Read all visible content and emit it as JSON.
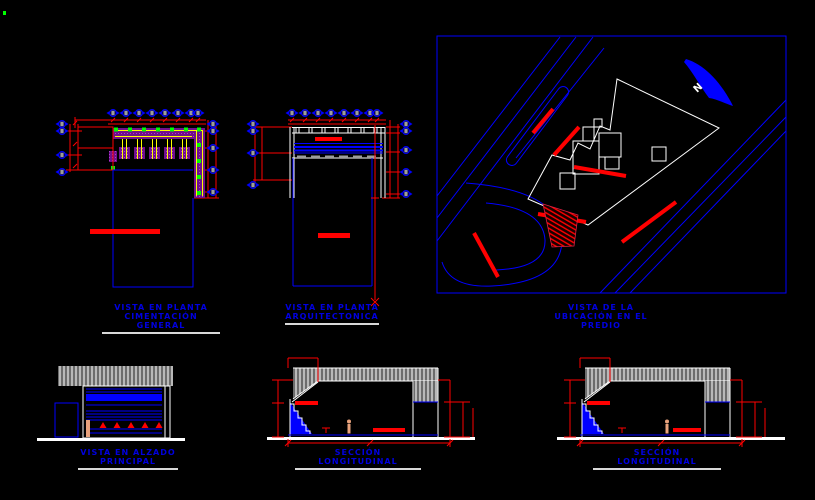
{
  "colors": {
    "background": "#000000",
    "red": "#ff0000",
    "blue": "#0000ff",
    "yellow": "#ffff00",
    "green": "#00ff00",
    "purple": "#70108c",
    "purple_dot": "#b03ad0",
    "gray": "#9e9e9e",
    "hatch_gray": "#b8b8b8",
    "hatch_dark": "#3a3a3a",
    "white": "#ffffff",
    "skin": "#e8a27c",
    "label": "#0000e0",
    "underline": "#d8d8d8"
  },
  "labels": {
    "plan_foundation": {
      "line1": "VISTA EN PLANTA",
      "line2": "CIMENTACIÓN GENERAL"
    },
    "plan_architectural": {
      "line1": "VISTA EN PLANTA",
      "line2": "ARQUITECTONICA"
    },
    "site_location": {
      "line1": "VISTA DE LA",
      "line2": "UBICACIÓN EN EL PREDIO"
    },
    "front_elevation": {
      "line1": "VISTA EN ALZADO",
      "line2": "PRINCIPAL"
    },
    "section_a": {
      "line1": "SECCIÓN LONGITUDINAL"
    },
    "section_b": {
      "line1": "SECCIÓN LONGITUDINAL"
    }
  },
  "site": {
    "north_label": "N"
  }
}
